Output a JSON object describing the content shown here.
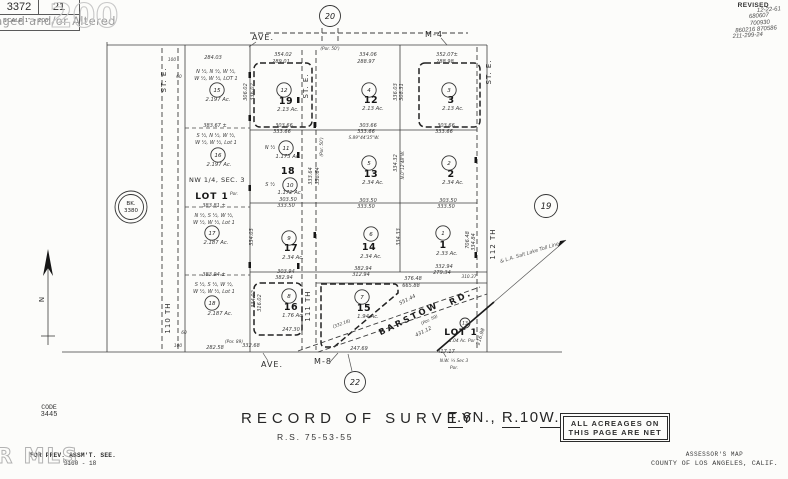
{
  "title_block": {
    "book": "3372",
    "page": "21",
    "scale": "SCALE 1\" = 200'"
  },
  "watermarks": {
    "photo": "Photo Virtually Staged and/or Altered",
    "stamp": "200",
    "mls": "GAVAR MLS"
  },
  "revisions": {
    "heading": "REVISED",
    "entries": [
      "12-22-61",
      "680607",
      "700930",
      "860216 870586",
      "211-299-24"
    ]
  },
  "footer": {
    "record_title": "RECORD OF SURVEY",
    "record_ref": "R.S. 75-53-55",
    "township_parts": [
      {
        "text": "T.",
        "u": true
      },
      {
        "text": "6N., ",
        "u": false
      },
      {
        "text": "R.",
        "u": true
      },
      {
        "text": "10",
        "u": false
      },
      {
        "text": "W.",
        "u": true
      }
    ],
    "acreage_note_line1": "ALL ACREAGES ON",
    "acreage_note_line2": "THIS PAGE ARE NET",
    "code_label": "CODE",
    "code_value": "3445",
    "prev_assmt": "FOR PREV. ASSM'T. SEE.",
    "prev_assmt_ref": "3160 - 18",
    "assessor_line1": "ASSESSOR'S MAP",
    "assessor_line2": "COUNTY OF LOS ANGELES, CALIF."
  },
  "map": {
    "book_ref": {
      "line1": "BK.",
      "line2": "3380"
    },
    "circles": [
      {
        "n": "15",
        "x": 217,
        "y": 90
      },
      {
        "n": "16",
        "x": 218,
        "y": 155
      },
      {
        "n": "17",
        "x": 212,
        "y": 233
      },
      {
        "n": "18",
        "x": 212,
        "y": 303
      },
      {
        "n": "12",
        "x": 284,
        "y": 90
      },
      {
        "n": "11",
        "x": 286,
        "y": 148
      },
      {
        "n": "10",
        "x": 290,
        "y": 185
      },
      {
        "n": "9",
        "x": 289,
        "y": 238
      },
      {
        "n": "8",
        "x": 289,
        "y": 296
      },
      {
        "n": "4",
        "x": 369,
        "y": 90
      },
      {
        "n": "5",
        "x": 369,
        "y": 163
      },
      {
        "n": "6",
        "x": 371,
        "y": 234
      },
      {
        "n": "7",
        "x": 362,
        "y": 297
      },
      {
        "n": "3",
        "x": 449,
        "y": 90
      },
      {
        "n": "2",
        "x": 449,
        "y": 163
      },
      {
        "n": "1",
        "x": 443,
        "y": 233
      },
      {
        "n": "13",
        "x": 465,
        "y": 323,
        "r": 5,
        "fs": 4.5
      },
      {
        "n": "20",
        "x": 330,
        "y": 16,
        "r": 10.5,
        "fs": 8,
        "nm": "sheet-ref-circle"
      },
      {
        "n": "22",
        "x": 355,
        "y": 382,
        "r": 10.5,
        "fs": 8,
        "nm": "sheet-ref-circle"
      },
      {
        "n": "19",
        "x": 546,
        "y": 206,
        "r": 11.5,
        "fs": 8.5,
        "nm": "sheet-ref-circle"
      }
    ],
    "labels": [
      {
        "t": "AVE.",
        "x": 263,
        "y": 40,
        "k": "s"
      },
      {
        "t": "M-4",
        "x": 434,
        "y": 37,
        "k": "s"
      },
      {
        "t": "AVE.",
        "x": 272,
        "y": 367,
        "k": "s"
      },
      {
        "t": "M-8",
        "x": 323,
        "y": 364,
        "k": "s"
      },
      {
        "t": "ST. E.",
        "x": 166,
        "y": 80,
        "k": "sv",
        "r": -90
      },
      {
        "t": "110 TH",
        "x": 170,
        "y": 318,
        "k": "sv",
        "r": -90
      },
      {
        "t": "ST. E.",
        "x": 308,
        "y": 86,
        "k": "sv",
        "r": -90
      },
      {
        "t": "111 TH",
        "x": 310,
        "y": 306,
        "k": "sv",
        "r": -90
      },
      {
        "t": "ST. E.",
        "x": 491,
        "y": 72,
        "k": "sv",
        "r": -90
      },
      {
        "t": "112 TH",
        "x": 495,
        "y": 244,
        "k": "sv",
        "r": -90
      },
      {
        "t": "BARSTOW",
        "x": 410,
        "y": 321,
        "k": "sb",
        "r": -26
      },
      {
        "t": "RD.",
        "x": 462,
        "y": 300,
        "k": "sb",
        "r": -26
      },
      {
        "t": "& L.A. Salt Lake Toll Line",
        "x": 530,
        "y": 254,
        "k": "rr",
        "r": -17
      },
      {
        "t": "N",
        "x": 44,
        "y": 299,
        "k": "sv",
        "r": -90
      },
      {
        "t": "(Por. 50')",
        "x": 330,
        "y": 50,
        "k": "t"
      },
      {
        "t": "284.03",
        "x": 213,
        "y": 59,
        "k": "m"
      },
      {
        "t": "354.02",
        "x": 283,
        "y": 56,
        "k": "m"
      },
      {
        "t": "289.01",
        "x": 281,
        "y": 63,
        "k": "m"
      },
      {
        "t": "334.06",
        "x": 368,
        "y": 56,
        "k": "m"
      },
      {
        "t": "288.97",
        "x": 366,
        "y": 63,
        "k": "m"
      },
      {
        "t": "352.07±",
        "x": 447,
        "y": 56,
        "k": "m"
      },
      {
        "t": "288.98",
        "x": 445,
        "y": 63,
        "k": "m"
      },
      {
        "t": "100",
        "x": 172,
        "y": 61,
        "k": "t"
      },
      {
        "t": "60",
        "x": 179,
        "y": 78,
        "k": "t"
      },
      {
        "t": "60",
        "x": 184,
        "y": 334,
        "k": "t"
      },
      {
        "t": "100",
        "x": 178,
        "y": 347,
        "k": "t"
      },
      {
        "t": "N ½, N ½, W ½,",
        "x": 216,
        "y": 73,
        "k": "d"
      },
      {
        "t": "W ½, W ½, LOT 1",
        "x": 216,
        "y": 80,
        "k": "d"
      },
      {
        "t": "2.197 Ac.",
        "x": 218,
        "y": 101,
        "k": "a"
      },
      {
        "t": "383.67 ±",
        "x": 215,
        "y": 127,
        "k": "m"
      },
      {
        "t": "S ½, N ½, W ½,",
        "x": 216,
        "y": 137,
        "k": "d"
      },
      {
        "t": "W ½, W ½, Lot 1",
        "x": 216,
        "y": 144,
        "k": "d"
      },
      {
        "t": "2.197 Ac.",
        "x": 219,
        "y": 166,
        "k": "a"
      },
      {
        "t": "NW 1/4, SEC. 3",
        "x": 217,
        "y": 182,
        "k": "n"
      },
      {
        "t": "LOT 1",
        "x": 212,
        "y": 199,
        "k": "b2"
      },
      {
        "t": "Por.",
        "x": 234,
        "y": 195,
        "k": "t"
      },
      {
        "t": "383.81 ±",
        "x": 214,
        "y": 207,
        "k": "m"
      },
      {
        "t": "N ½, S ½, W ½,",
        "x": 214,
        "y": 217,
        "k": "d"
      },
      {
        "t": "W ½, W ½, Lot 1",
        "x": 214,
        "y": 224,
        "k": "d"
      },
      {
        "t": "2.187 Ac.",
        "x": 216,
        "y": 244,
        "k": "a"
      },
      {
        "t": "383.94 ±",
        "x": 214,
        "y": 276,
        "k": "m"
      },
      {
        "t": "S ½, S ½, W ½,",
        "x": 214,
        "y": 286,
        "k": "d"
      },
      {
        "t": "W ½, W ½, Lot 1",
        "x": 214,
        "y": 293,
        "k": "d"
      },
      {
        "t": "2.187 Ac.",
        "x": 220,
        "y": 315,
        "k": "a"
      },
      {
        "t": "19",
        "x": 286,
        "y": 104,
        "k": "b"
      },
      {
        "t": "2.13 Ac.",
        "x": 288,
        "y": 111,
        "k": "a"
      },
      {
        "t": "303.66",
        "x": 284,
        "y": 127,
        "k": "m"
      },
      {
        "t": "333.66",
        "x": 282,
        "y": 133,
        "k": "m"
      },
      {
        "t": "N ½",
        "x": 270,
        "y": 149,
        "k": "d"
      },
      {
        "t": "1.173 Ac.",
        "x": 288,
        "y": 158,
        "k": "a"
      },
      {
        "t": "18",
        "x": 288,
        "y": 174,
        "k": "b"
      },
      {
        "t": "S ½",
        "x": 270,
        "y": 186,
        "k": "d"
      },
      {
        "t": "1.172 Ac.",
        "x": 290,
        "y": 194,
        "k": "a"
      },
      {
        "t": "303.50",
        "x": 288,
        "y": 201,
        "k": "m"
      },
      {
        "t": "333.50",
        "x": 286,
        "y": 207,
        "k": "m"
      },
      {
        "t": "17",
        "x": 291,
        "y": 251,
        "k": "b"
      },
      {
        "t": "2.34 Ac.",
        "x": 293,
        "y": 259,
        "k": "a"
      },
      {
        "t": "303.94",
        "x": 286,
        "y": 273,
        "k": "m"
      },
      {
        "t": "382.94",
        "x": 284,
        "y": 279,
        "k": "m"
      },
      {
        "t": "16",
        "x": 291,
        "y": 310,
        "k": "b"
      },
      {
        "t": "1.76 Ac.",
        "x": 293,
        "y": 317,
        "k": "a"
      },
      {
        "t": "247.30",
        "x": 291,
        "y": 331,
        "k": "m"
      },
      {
        "t": "(Por. 89)",
        "x": 234,
        "y": 343,
        "k": "t"
      },
      {
        "t": "332.68",
        "x": 251,
        "y": 347,
        "k": "m"
      },
      {
        "t": "12",
        "x": 371,
        "y": 103,
        "k": "b"
      },
      {
        "t": "2.13 Ac.",
        "x": 373,
        "y": 110,
        "k": "a"
      },
      {
        "t": "303.66",
        "x": 368,
        "y": 127,
        "k": "m"
      },
      {
        "t": "333.66",
        "x": 366,
        "y": 133,
        "k": "m"
      },
      {
        "t": "S.89°44'35\"W.",
        "x": 364,
        "y": 139,
        "k": "t"
      },
      {
        "t": "13",
        "x": 371,
        "y": 177,
        "k": "b"
      },
      {
        "t": "2.34 Ac.",
        "x": 373,
        "y": 184,
        "k": "a"
      },
      {
        "t": "303.50",
        "x": 368,
        "y": 202,
        "k": "m"
      },
      {
        "t": "333.50",
        "x": 366,
        "y": 208,
        "k": "m"
      },
      {
        "t": "14",
        "x": 369,
        "y": 250,
        "k": "b"
      },
      {
        "t": "2.34 Ac.",
        "x": 371,
        "y": 258,
        "k": "a"
      },
      {
        "t": "382.94",
        "x": 363,
        "y": 270,
        "k": "m"
      },
      {
        "t": "312.94",
        "x": 361,
        "y": 276,
        "k": "m"
      },
      {
        "t": "376.48",
        "x": 413,
        "y": 280,
        "k": "m"
      },
      {
        "t": "665.88",
        "x": 411,
        "y": 287,
        "k": "m"
      },
      {
        "t": "15",
        "x": 364,
        "y": 311,
        "k": "b"
      },
      {
        "t": "1.94 Ac.",
        "x": 368,
        "y": 318,
        "k": "a"
      },
      {
        "t": "(332.18)",
        "x": 342,
        "y": 325,
        "k": "t",
        "r": -20
      },
      {
        "t": "3",
        "x": 451,
        "y": 103,
        "k": "b"
      },
      {
        "t": "2.13 Ac.",
        "x": 453,
        "y": 110,
        "k": "a"
      },
      {
        "t": "303.66",
        "x": 446,
        "y": 127,
        "k": "m"
      },
      {
        "t": "333.66",
        "x": 444,
        "y": 133,
        "k": "m"
      },
      {
        "t": "2",
        "x": 451,
        "y": 177,
        "k": "b"
      },
      {
        "t": "2.34 Ac.",
        "x": 453,
        "y": 184,
        "k": "a"
      },
      {
        "t": "303.50",
        "x": 448,
        "y": 202,
        "k": "m"
      },
      {
        "t": "333.50",
        "x": 446,
        "y": 208,
        "k": "m"
      },
      {
        "t": "1",
        "x": 443,
        "y": 248,
        "k": "b"
      },
      {
        "t": "2.33 Ac.",
        "x": 447,
        "y": 255,
        "k": "a"
      },
      {
        "t": "332.94",
        "x": 444,
        "y": 268,
        "k": "m"
      },
      {
        "t": "279.34",
        "x": 442,
        "y": 274,
        "k": "m"
      },
      {
        "t": "310.37",
        "x": 469,
        "y": 278,
        "k": "t"
      },
      {
        "t": "LOT 1",
        "x": 461,
        "y": 335,
        "k": "b2"
      },
      {
        "t": "1.04 Ac. Por",
        "x": 462,
        "y": 342,
        "k": "t"
      },
      {
        "t": "417.17",
        "x": 446,
        "y": 353,
        "k": "m"
      },
      {
        "t": "N.W. ¼ Sec 3",
        "x": 454,
        "y": 362,
        "k": "t"
      },
      {
        "t": "Por.",
        "x": 454,
        "y": 369,
        "k": "t"
      },
      {
        "t": "306.02",
        "x": 247,
        "y": 92,
        "k": "m",
        "r": -90
      },
      {
        "t": "336.02",
        "x": 254,
        "y": 92,
        "k": "m",
        "r": -90
      },
      {
        "t": "334.03",
        "x": 253,
        "y": 237,
        "k": "m",
        "r": -90
      },
      {
        "t": "334.02",
        "x": 255,
        "y": 299,
        "k": "m",
        "r": -90
      },
      {
        "t": "316.02",
        "x": 261,
        "y": 303,
        "k": "m",
        "r": -90
      },
      {
        "t": "(Por. 50')",
        "x": 323,
        "y": 147,
        "k": "t",
        "r": -90
      },
      {
        "t": "333.64",
        "x": 312,
        "y": 176,
        "k": "m",
        "r": -90
      },
      {
        "t": "338.64",
        "x": 319,
        "y": 176,
        "k": "m",
        "r": -90
      },
      {
        "t": "336.03",
        "x": 397,
        "y": 92,
        "k": "m",
        "r": -90
      },
      {
        "t": "308.31",
        "x": 403,
        "y": 92,
        "k": "m",
        "r": -90
      },
      {
        "t": "334.32",
        "x": 397,
        "y": 163,
        "k": "m",
        "r": -90
      },
      {
        "t": "N.0°12'48\"W.",
        "x": 404,
        "y": 165,
        "k": "t",
        "r": -90
      },
      {
        "t": "334.33",
        "x": 400,
        "y": 237,
        "k": "m",
        "r": -90
      },
      {
        "t": "706.48",
        "x": 469,
        "y": 240,
        "k": "m",
        "r": -90
      },
      {
        "t": "334.84",
        "x": 475,
        "y": 242,
        "k": "m",
        "r": -90
      },
      {
        "t": "216.98",
        "x": 482,
        "y": 337,
        "k": "m",
        "r": -72
      },
      {
        "t": "551.44",
        "x": 408,
        "y": 301,
        "k": "m",
        "r": -26
      },
      {
        "t": "(Por. 59)",
        "x": 430,
        "y": 321,
        "k": "t",
        "r": -26
      },
      {
        "t": "431.12",
        "x": 424,
        "y": 333,
        "k": "m",
        "r": -26
      },
      {
        "t": "282.58",
        "x": 215,
        "y": 349,
        "k": "m"
      },
      {
        "t": "247.69",
        "x": 359,
        "y": 350,
        "k": "m"
      }
    ]
  }
}
